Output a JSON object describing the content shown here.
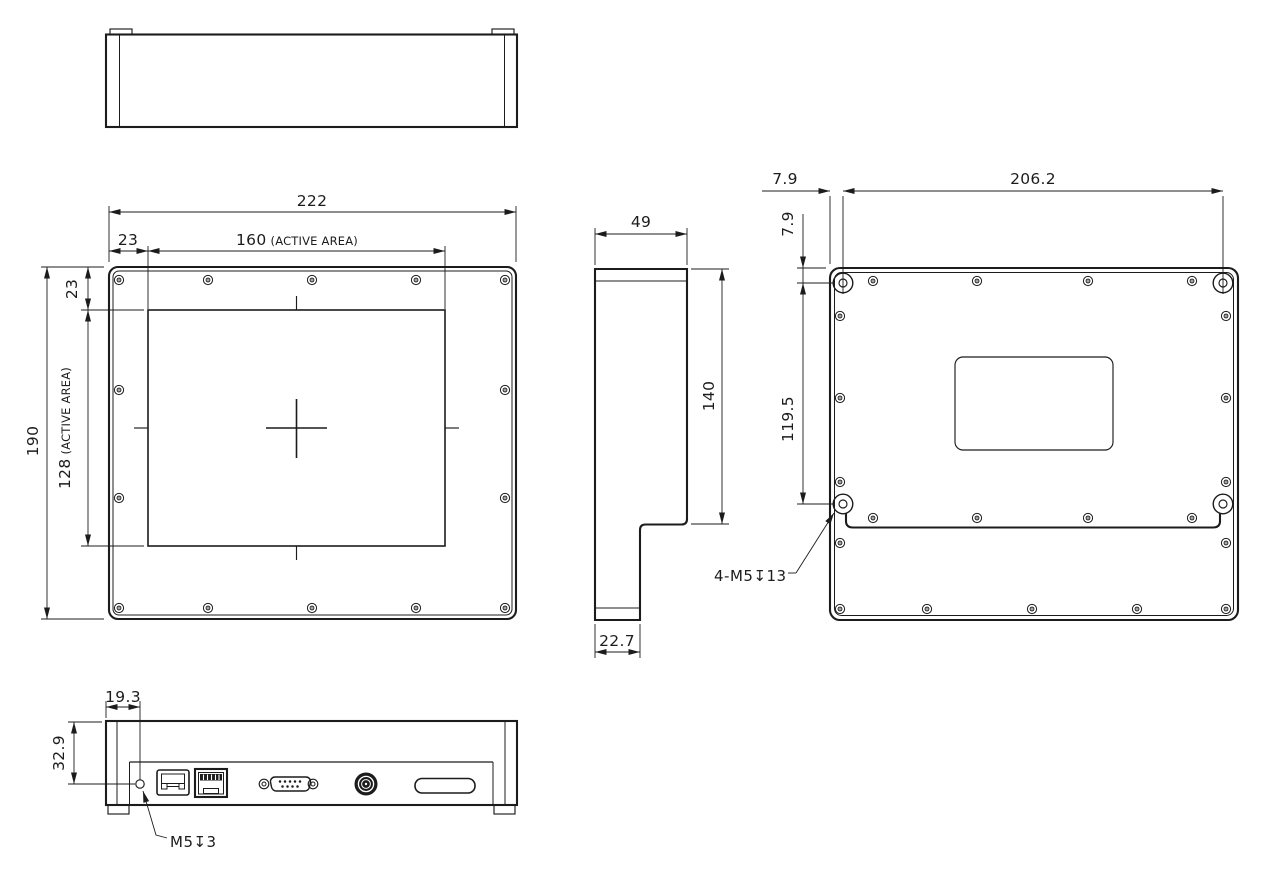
{
  "front_view": {
    "overall_width": "222",
    "bezel_offset_left": "23",
    "active_width": "160",
    "active_width_note": "(ACTIVE AREA)",
    "bezel_offset_top": "23",
    "active_height": "128",
    "active_height_note": "(ACTIVE AREA)",
    "overall_height": "190"
  },
  "side_view": {
    "depth": "49",
    "panel_height": "140",
    "base_depth": "22.7"
  },
  "back_view": {
    "mount_hole_offset_x": "7.9",
    "mount_hole_span_x": "206.2",
    "mount_hole_offset_y": "7.9",
    "mount_hole_span_y": "119.5",
    "mount_hole_note": "4-M5↧13"
  },
  "bottom_view": {
    "thread_hole_offset_x": "19.3",
    "thread_hole_offset_y": "32.9",
    "thread_hole_note": "M5↧3"
  },
  "colors": {
    "line": "#1c1c1c",
    "background": "#ffffff"
  }
}
